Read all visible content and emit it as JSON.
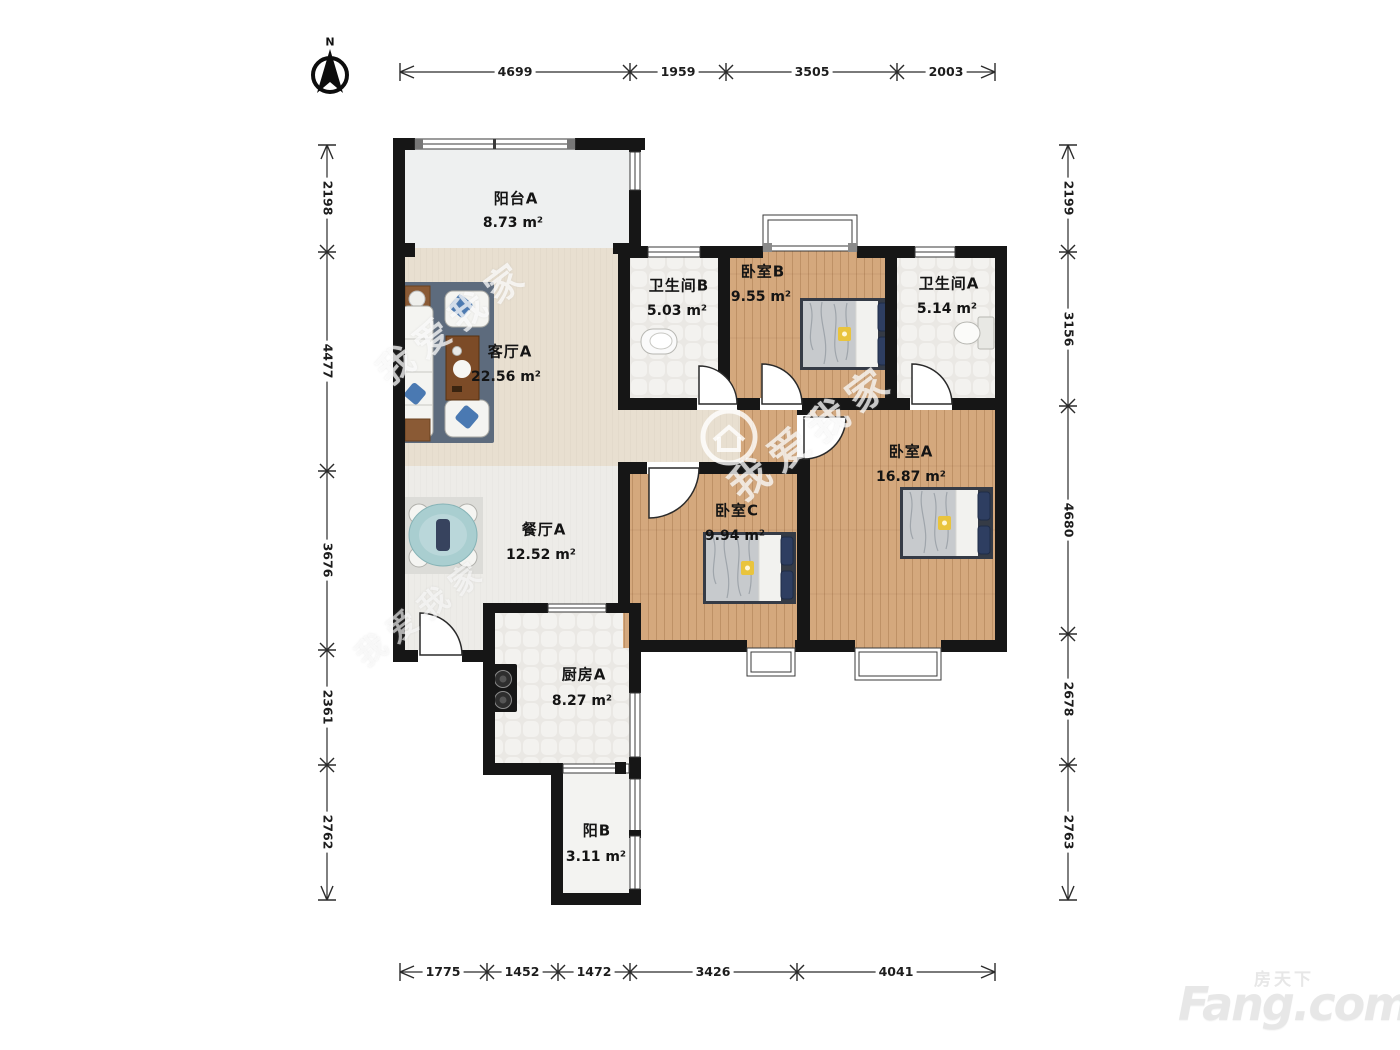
{
  "compass": {
    "label": "N"
  },
  "rooms": {
    "balcony_a": {
      "name": "阳台A",
      "area": "8.73 m²"
    },
    "living": {
      "name": "客厅A",
      "area": "22.56 m²"
    },
    "bath_b": {
      "name": "卫生间B",
      "area": "5.03 m²"
    },
    "bed_b": {
      "name": "卧室B",
      "area": "9.55 m²"
    },
    "bath_a": {
      "name": "卫生间A",
      "area": "5.14 m²"
    },
    "bed_a": {
      "name": "卧室A",
      "area": "16.87 m²"
    },
    "bed_c": {
      "name": "卧室C",
      "area": "9.94 m²"
    },
    "dining": {
      "name": "餐厅A",
      "area": "12.52 m²"
    },
    "kitchen": {
      "name": "厨房A",
      "area": "8.27 m²"
    },
    "balcony_b": {
      "name": "阳B",
      "area": "3.11 m²"
    }
  },
  "dimensions": {
    "top": [
      "4699",
      "1959",
      "3505",
      "2003"
    ],
    "bottom": [
      "1775",
      "1452",
      "1472",
      "3426",
      "4041"
    ],
    "left": [
      "2198",
      "4477",
      "3676",
      "2361",
      "2762"
    ],
    "right": [
      "2199",
      "3156",
      "4680",
      "2678",
      "2763"
    ]
  },
  "watermark": {
    "text": "我爱我家"
  },
  "logo": {
    "cn": "房天下",
    "en": "Fang.com"
  }
}
